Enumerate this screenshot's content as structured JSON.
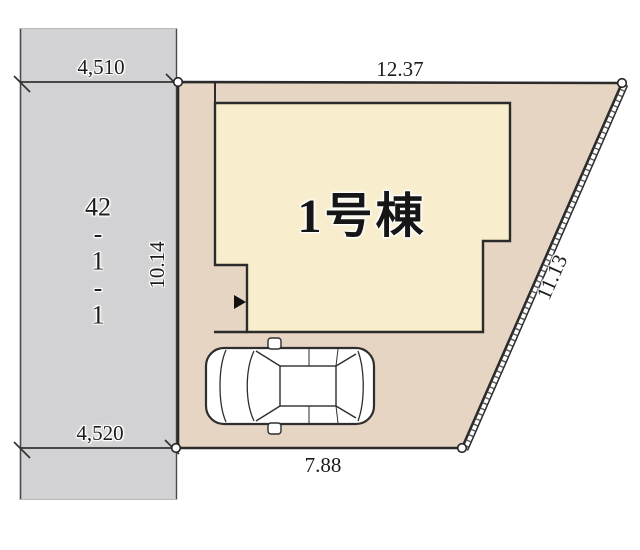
{
  "plan": {
    "building_label": "1号棟",
    "parcel_label": "42\n-\n1\n-\n1",
    "dimensions": {
      "road_top": "4,510",
      "road_bottom": "4,520",
      "lot_top": "12.37",
      "lot_left": "10.14",
      "lot_right": "11.13",
      "lot_bottom": "7.88"
    },
    "icons": {
      "entrance_arrow": "right-pointing-triangle",
      "corner_marker": "survey-point-circle",
      "car": "sedan-top-view"
    }
  },
  "colors": {
    "road_fill": "#d2d2d4",
    "lot_fill": "#e6d5c3",
    "building_fill": "#f8eecd",
    "outline": "#2b2b2b",
    "car_fill": "#ffffff",
    "text": "#1c1c1c"
  }
}
